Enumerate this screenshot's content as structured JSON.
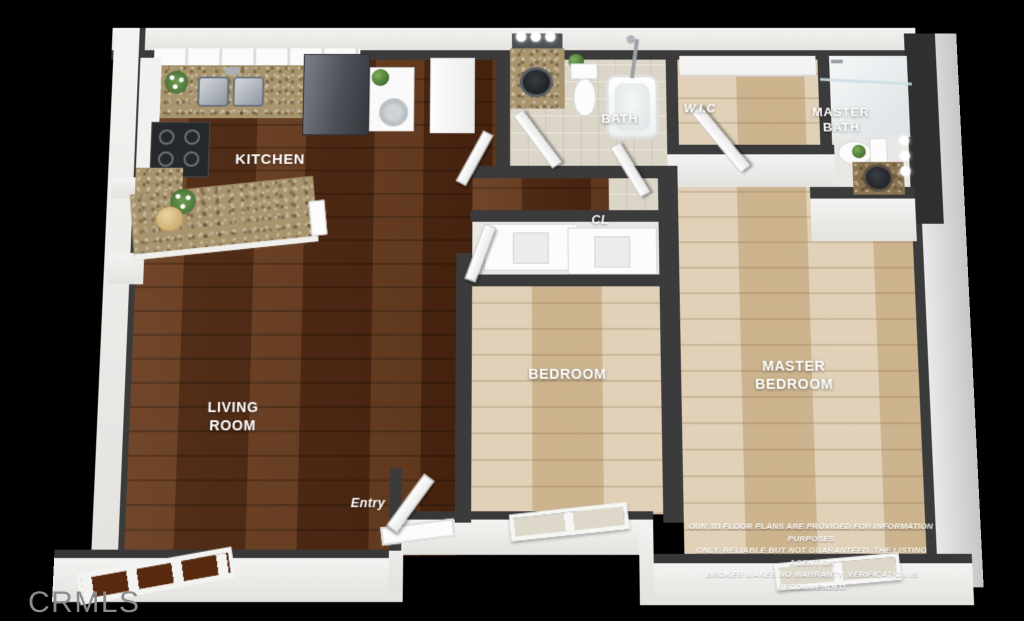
{
  "title": "3D floor plan rendering",
  "rooms": {
    "kitchen": {
      "label": "KITCHEN"
    },
    "living_room": {
      "label": "LIVING\nROOM"
    },
    "bath": {
      "label": "BATH"
    },
    "wic": {
      "label": "W.I.C"
    },
    "master_bath": {
      "label": "MASTER\nBATH"
    },
    "closet": {
      "label": "CL"
    },
    "bedroom": {
      "label": "BEDROOM"
    },
    "master_bedroom": {
      "label": "MASTER\nBEDROOM"
    },
    "entry": {
      "label": "Entry"
    }
  },
  "disclaimer": {
    "line1": "OUR 3D FLOOR PLANS ARE PROVIDED FOR INFORMATION PURPOSES",
    "line2": "ONLY. RELIABLE BUT NOT GUARANTEED. THE LISTING AGENT OR",
    "line3": "BROKER MAKES NO WARRANTY. VERIFICATION IS RECOMMENDED."
  },
  "watermark": {
    "label": "CRMLS"
  },
  "colors": {
    "background": "#000000",
    "wall_dark": "#3b3b3b",
    "wall_white": "#f2f1ef",
    "wood_dark": "#5c2e13",
    "wood_light": "#d3bd99",
    "granite": "#a8956e",
    "label_text": "#ffffff",
    "watermark_text": "#8b8b8b"
  }
}
